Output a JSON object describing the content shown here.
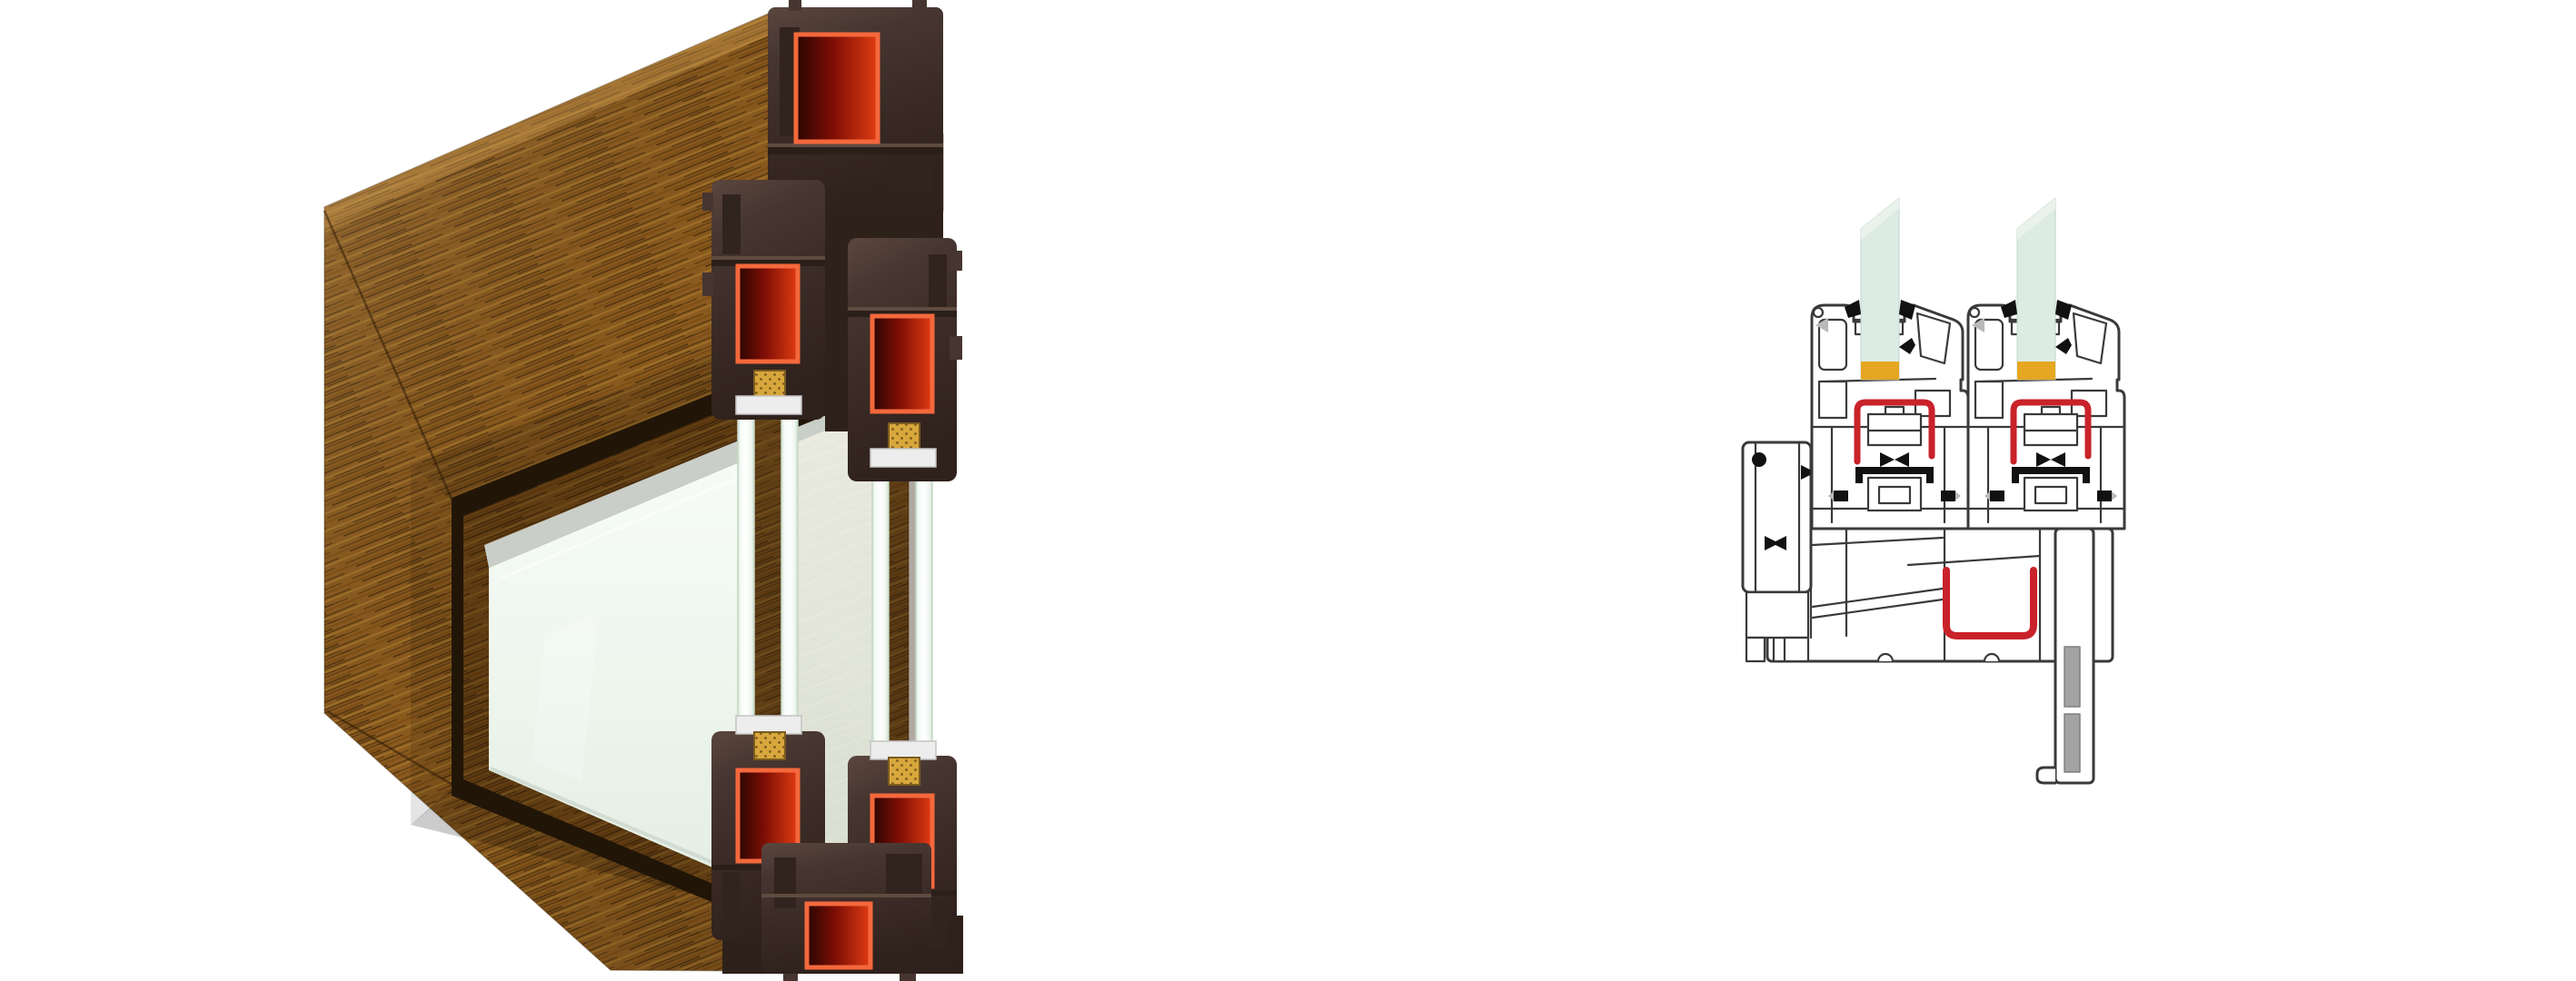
{
  "scene": {
    "background": "#ffffff",
    "left_illustration": {
      "name": "window-corner-cutaway-render",
      "kind": "3d-render",
      "parts": [
        "oak-laminate-frame",
        "pvc-profile-sections",
        "steel-reinforcement-pockets",
        "double-glazing-units",
        "glazing-spacers",
        "fixed-glass-pane"
      ]
    },
    "right_illustration": {
      "name": "window-profile-section-drawing",
      "kind": "technical-line-drawing",
      "parts": [
        "addon-profile",
        "sash-assembly-left",
        "sash-assembly-right",
        "glass-panes",
        "glazing-packers",
        "steel-u-channels",
        "sill-profile",
        "drip-leg",
        "gaskets"
      ]
    }
  },
  "palette": {
    "background": "#ffffff",
    "wood_base": "#8a5a1e",
    "wood_streak_dark": "#3a2408",
    "wood_streak_mid": "#5d3a10",
    "wood_streak_light": "#a4762c",
    "wood_highlight": "#c89a4a",
    "pvc_light": "#5a463e",
    "pvc_base": "#463530",
    "pvc_mid": "#3b2b26",
    "pvc_dark": "#2f211c",
    "pvc_shadow": "#2d211a",
    "gasket_orange": "#f4683c",
    "gasket_red": "#e03c12",
    "gasket_red_mid": "#7e0e05",
    "gasket_red_dark": "#2a0602",
    "rebate_dark": "#211507",
    "silver_spacer": "#c9cec8",
    "glass_face_light": "#f7fbf7",
    "glass_face": "#eef6ee",
    "glass_face_deep": "#e4eee4",
    "pane_edge": "#cfe0cf",
    "spacer_gold": "#d8a73c",
    "spacer_gold_dot": "#7a5a1e",
    "spacer_white": "#ededed",
    "line_color": "#3a3a3a",
    "red_seal": "#c9222a",
    "amber_packer": "#e5a621",
    "glass_pane": "#dcebe4",
    "glass_pane_light": "#eaf2ec",
    "gray_infill": "#a3a3a3",
    "black_seal": "#111111",
    "gray_detail": "#b9b9b9"
  }
}
